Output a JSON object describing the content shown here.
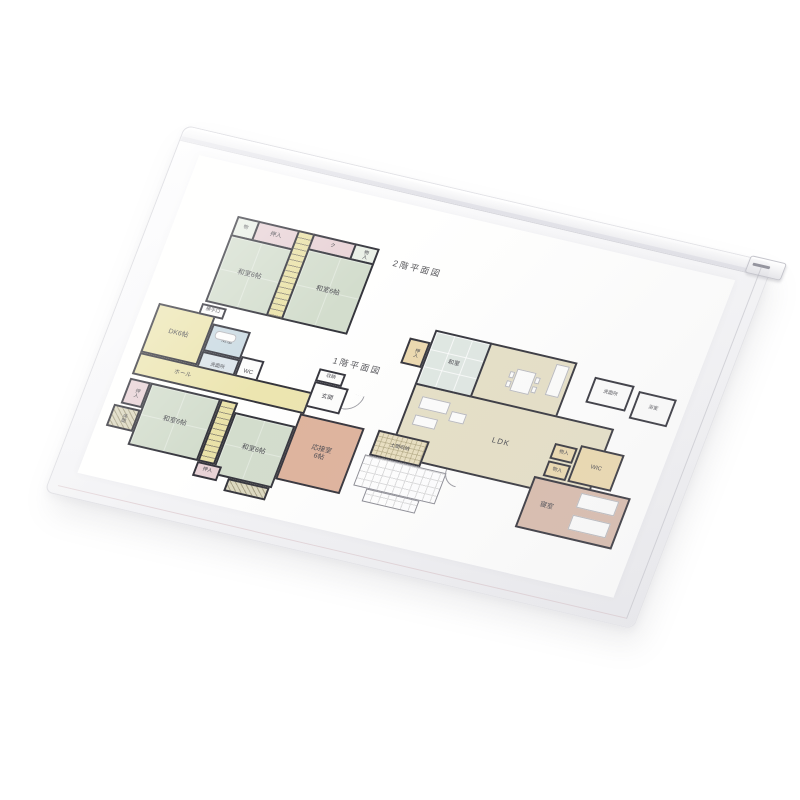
{
  "plans": {
    "floor2": {
      "title": "2階平面図",
      "rooms": {
        "mono": "物",
        "oshiire": "押入",
        "closet": "ク",
        "monoiri": "物入",
        "washitsu_left": "和室6帖",
        "washitsu_right": "和室6帖"
      }
    },
    "floor1_left": {
      "title": "1階平面図",
      "rooms": {
        "dk": "DK6帖",
        "katteguchi": "勝手口",
        "yokushitsu": "浴室",
        "senmenjo": "洗面所",
        "wc": "WC",
        "hall": "ホール",
        "shuno": "収納",
        "genkan": "玄関",
        "oshiire_a": "押入",
        "tokonoma": "床間",
        "washitsu_a": "和室6帖",
        "washitsu_b": "和室6帖",
        "oshiire_b": "押入",
        "ousetsu_name": "応接室",
        "ousetsu_size": "6帖"
      }
    },
    "floor1_right": {
      "rooms": {
        "oshiire": "押入",
        "washitsu": "和室",
        "ldk": "LDK",
        "doma": "土間収納",
        "senmenjo": "洗面所",
        "yokushitsu": "浴室",
        "monoiri_a": "物入",
        "monoiri_b": "物入",
        "wic": "WIC",
        "shinshitsu": "寝室"
      }
    }
  },
  "colors": {
    "wall": "#34343c",
    "tatami_green": "#d3ddcd",
    "dk_yellow": "#ece5b0",
    "closet_pink": "#e8d2d6",
    "bath_blue": "#cbdbe3",
    "reception_salmon": "#dfb39c",
    "bedroom_rose": "#d9bcac",
    "wic_cream": "#ecd9ae",
    "modern_floor_beige": "#e6e0c6",
    "stair_yellow": "#eae2a8"
  }
}
